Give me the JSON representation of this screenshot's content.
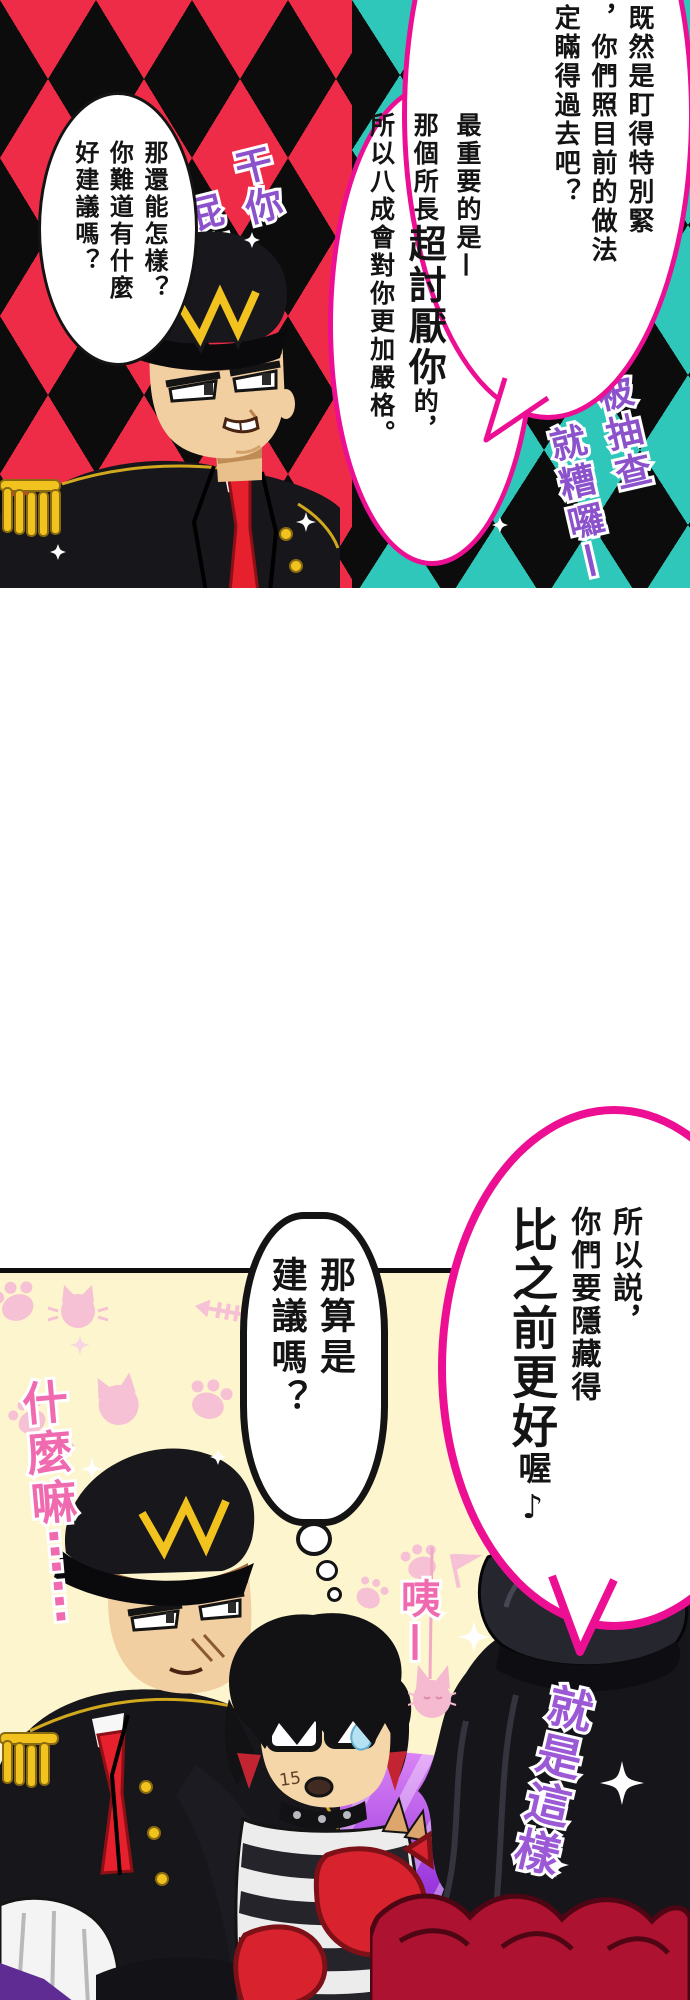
{
  "top_panel": {
    "bubble_top_right": {
      "col1": "既然是盯得特別緊",
      "col2": "，你們照目前的做法",
      "col3": "定瞞得過去吧？"
    },
    "bubble_center": {
      "col1": "最重要的是—",
      "col2_pre": "那個所長",
      "col2_big": "超討厭你",
      "col2_post": "的，",
      "col3": "所以八成會對你更加嚴格。"
    },
    "bubble_left": {
      "col1": "那還能怎樣？",
      "col2": "你難道有什麼",
      "col3": "好建議嗎？"
    },
    "sfx_left": {
      "col1": "干你",
      "col2": "屁事"
    },
    "sfx_right": {
      "col1": "要是被抽查",
      "col2": "就糟囉—"
    }
  },
  "bottom_panel": {
    "bubble_pink": {
      "col1": "所以説，",
      "col2": "你們要隱藏得",
      "col3_big": "比之前更好",
      "col3_small": "喔♪"
    },
    "bubble_thought": {
      "col1": "那算是",
      "col2": "建議嗎？"
    },
    "sfx_what": "什麼嘛⋯⋯",
    "sfx_eh": "咦—",
    "sfx_thats_it": "就是這樣",
    "cheek_mark": "15"
  },
  "colors": {
    "bubble_border_magenta": "#ec0f93",
    "diamond_red": "#ef2c47",
    "diamond_teal": "#2fc7ba",
    "diamond_black": "#0c0c0c",
    "panel_cream": "#fdf5cd",
    "doodle_pink": "#f6c0d5",
    "sfx_purple": "#8b52cc",
    "sfx_pink": "#f06ab0",
    "tie_red": "#e6202c",
    "uniform_gold": "#f2c21f",
    "glove_red": "#d8232e",
    "ruffle_red": "#ad1230"
  }
}
